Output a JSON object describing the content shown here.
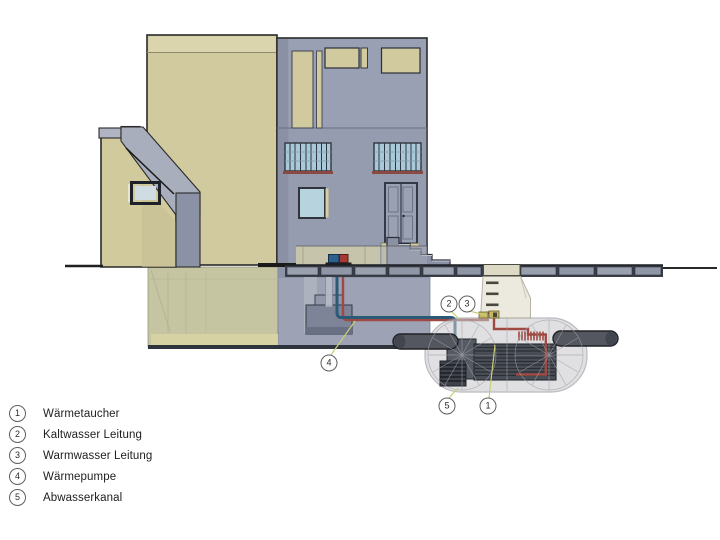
{
  "legend": {
    "items": [
      {
        "number": "1",
        "label": "Wärmetaucher"
      },
      {
        "number": "2",
        "label": "Kaltwasser Leitung"
      },
      {
        "number": "3",
        "label": "Warmwasser Leitung"
      },
      {
        "number": "4",
        "label": "Wärmepumpe"
      },
      {
        "number": "5",
        "label": "Abwasserkanal"
      }
    ]
  },
  "callouts": {
    "kaltwasser": {
      "number": "2"
    },
    "warmwasser": {
      "number": "3"
    },
    "waermepumpe": {
      "number": "4"
    },
    "abwasserkanal": {
      "number": "5"
    },
    "waermetaucher": {
      "number": "1"
    }
  },
  "colors": {
    "wall_cream": "#d0ca9e",
    "facade_gray": "#9aa0b3",
    "cold_water_pipe": "#2b5a78",
    "warm_water_pipe": "#9e4a42",
    "pavement_tile": "#99a0ae",
    "tank_shell": "#c8c8cc",
    "basement_cream": "#c1c19a"
  }
}
